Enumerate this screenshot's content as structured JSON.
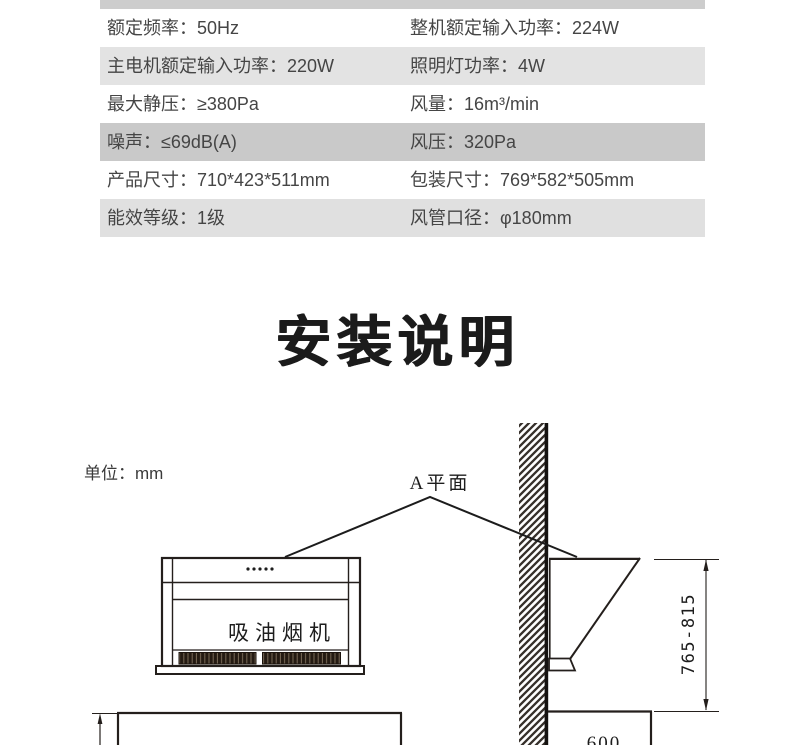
{
  "page": {
    "background": "#ffffff"
  },
  "spec_table": {
    "top_bar_color": "#cdcdcd",
    "text_color": "#454545",
    "rows": [
      {
        "left": "额定频率：50Hz",
        "right": "整机额定输入功率：224W",
        "bg": "#ffffff"
      },
      {
        "left": "主电机额定输入功率：220W",
        "right": "照明灯功率：4W",
        "bg": "#e3e3e3"
      },
      {
        "left": "最大静压：≥380Pa",
        "right": "风量：16m³/min",
        "bg": "#ffffff"
      },
      {
        "left": "噪声：≤69dB(A)",
        "right": "风压：320Pa",
        "bg": "#c9c9c9"
      },
      {
        "left": "产品尺寸：710*423*511mm",
        "right": "包装尺寸：769*582*505mm",
        "bg": "#ffffff"
      },
      {
        "left": "能效等级：1级",
        "right": "风管口径：φ180mm",
        "bg": "#e0e0e0"
      }
    ]
  },
  "section_title": "安装说明",
  "diagram": {
    "unit_label": "单位：mm",
    "plane_label": "A平面",
    "hood_label": "吸油烟机",
    "height_dimension": "765-815",
    "depth_dimension": "600",
    "line_color": "#241f1c"
  }
}
